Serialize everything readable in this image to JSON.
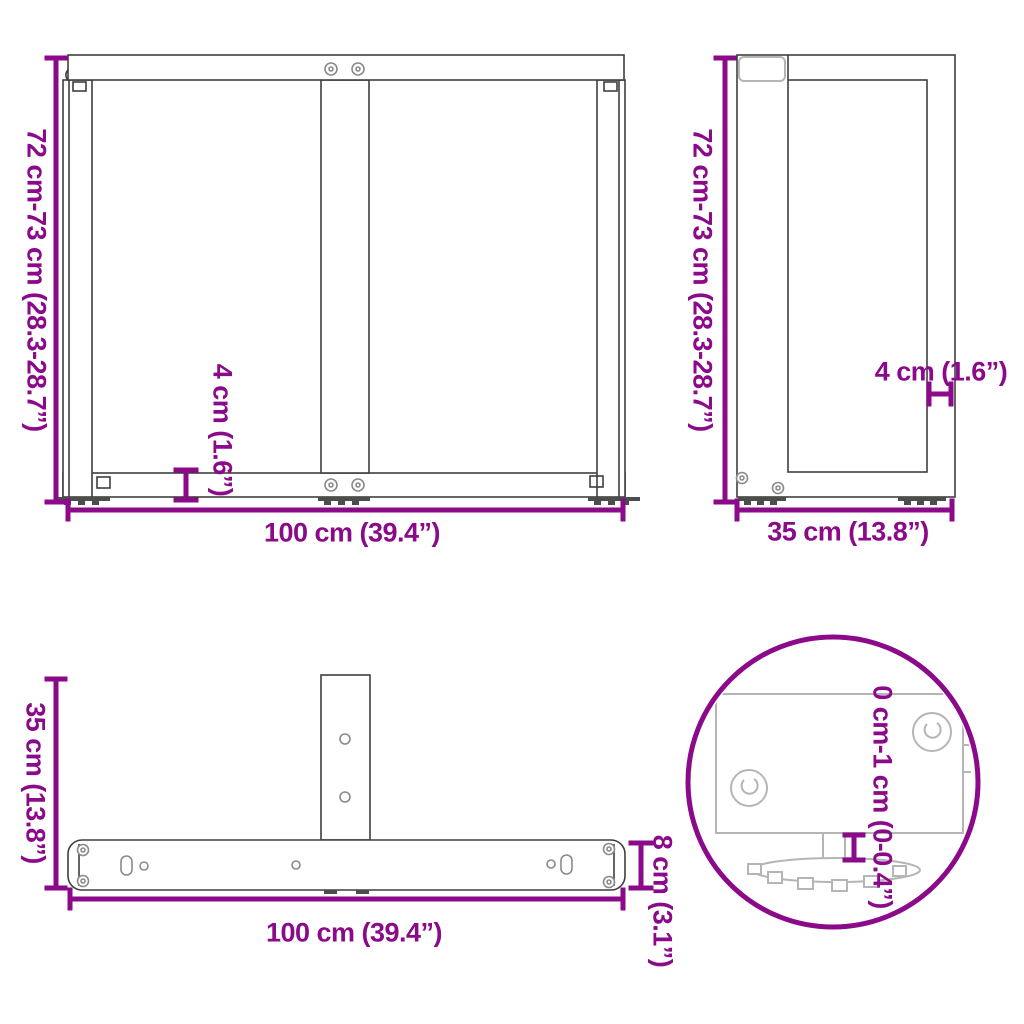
{
  "colors": {
    "accent": "#8a0a8a",
    "line": "#3f3f3f",
    "soft": "#8a8a8a",
    "light": "#b5b5b5",
    "dark": "#4d4d4d"
  },
  "views": {
    "front": {
      "height_label": "72 cm-73 cm (28.3-28.7”)",
      "width_label": "100 cm (39.4”)",
      "bar_label": "4 cm (1.6”)"
    },
    "side": {
      "height_label": "72 cm-73 cm (28.3-28.7”)",
      "depth_label": "35 cm (13.8”)",
      "bar_label": "4 cm (1.6”)"
    },
    "top": {
      "depth_label": "35 cm (13.8”)",
      "width_label": "100 cm (39.4”)",
      "bar_label": "8 cm (3.1”)"
    },
    "detail": {
      "adjust_label": "0 cm-1 cm (0-0.4”)"
    }
  }
}
